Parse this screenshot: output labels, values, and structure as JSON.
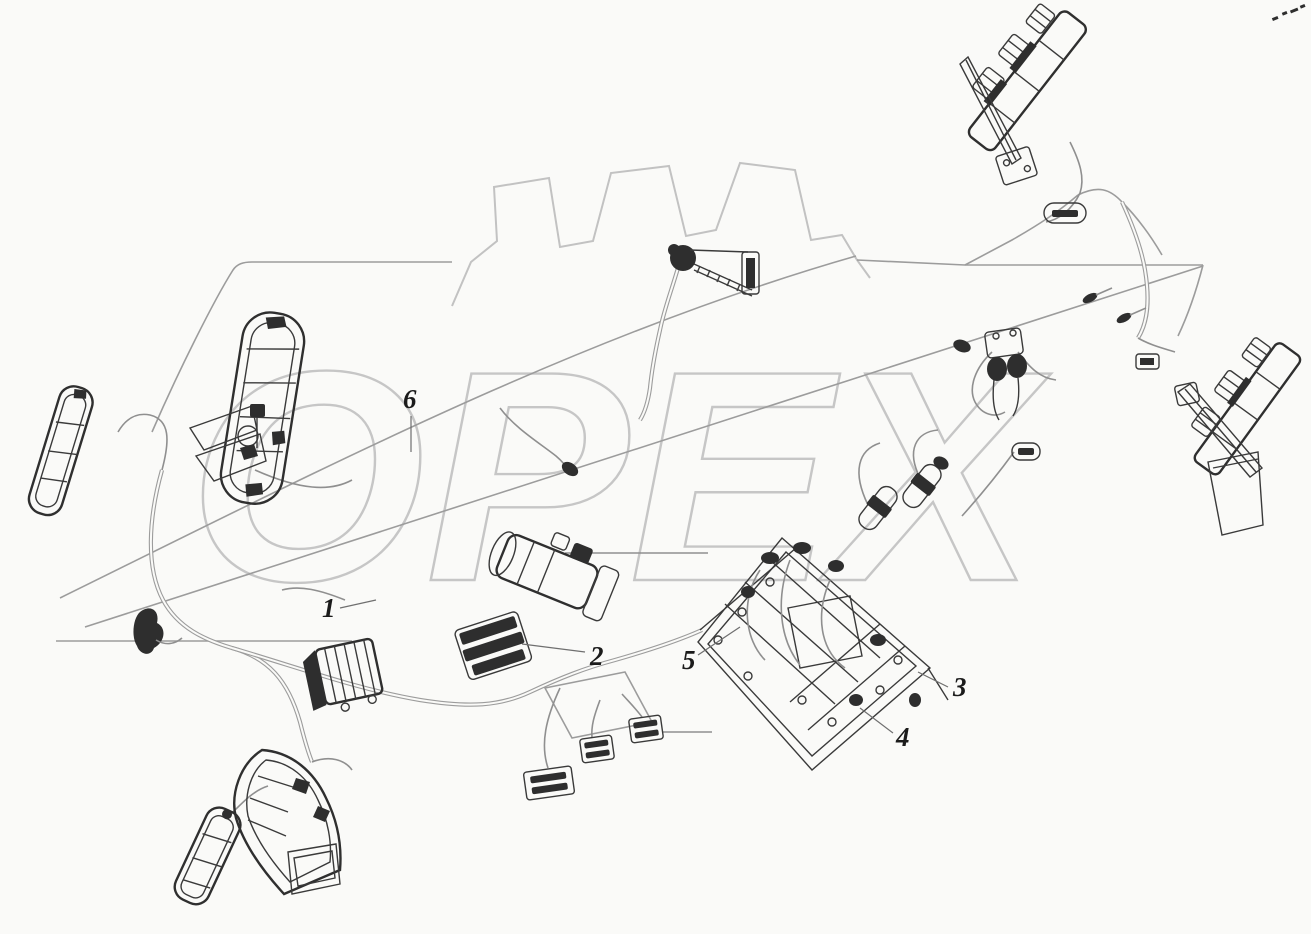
{
  "watermark": {
    "text": "OPEX",
    "color": "#c6c6c6"
  },
  "callouts": {
    "c1": {
      "label": "1"
    },
    "c2": {
      "label": "2"
    },
    "c3": {
      "label": "3"
    },
    "c4": {
      "label": "4"
    },
    "c5": {
      "label": "5"
    },
    "c6": {
      "label": "6"
    }
  },
  "colors": {
    "background": "#fafaf8",
    "harness_line": "#9c9c9c",
    "component_line": "#3a3a3a",
    "component_fill": "#2e2e2e",
    "watermark": "#c6c6c6",
    "callout_text": "#1b1b1b"
  }
}
